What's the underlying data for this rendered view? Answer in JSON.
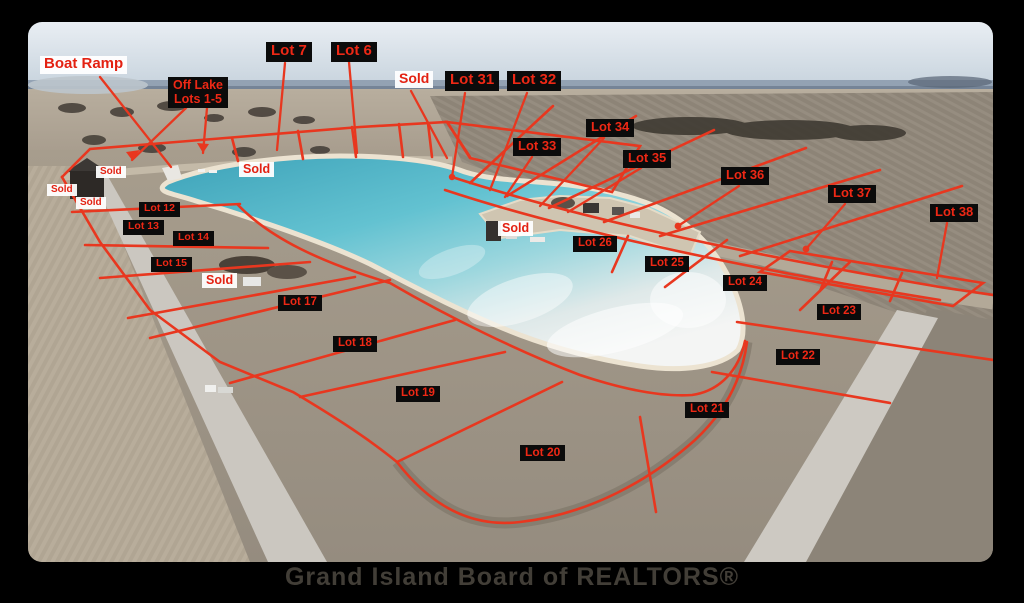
{
  "frame": {
    "watermark": "Grand Island Board of REALTORS®"
  },
  "colors": {
    "line_red": "#e8371f",
    "label_dark_bg": "#0b0b0b",
    "label_red_text": "#ee2815",
    "label_light_bg": "#ffffff",
    "lake_teal": "#54b6c8",
    "lake_glare": "#f3f5f4",
    "field_tan": "#a89d8e",
    "sky": "#dbe5ec"
  },
  "labels": [
    {
      "id": "boat-ramp",
      "text": "Boat Ramp",
      "style": "light",
      "x": 40,
      "y": 56,
      "fs": 15
    },
    {
      "id": "off-lake-lots-1-5",
      "text": "Off Lake\nLots 1-5",
      "style": "dark center",
      "x": 168,
      "y": 77,
      "fs": 12.5
    },
    {
      "id": "lot-7",
      "text": "Lot 7",
      "style": "dark",
      "x": 266,
      "y": 42,
      "fs": 15
    },
    {
      "id": "lot-6",
      "text": "Lot 6",
      "style": "dark",
      "x": 331,
      "y": 42,
      "fs": 15
    },
    {
      "id": "sold-top",
      "text": "Sold",
      "style": "light",
      "x": 395,
      "y": 71,
      "fs": 14
    },
    {
      "id": "lot-31",
      "text": "Lot 31",
      "style": "dark",
      "x": 445,
      "y": 71,
      "fs": 15
    },
    {
      "id": "lot-32",
      "text": "Lot 32",
      "style": "dark",
      "x": 507,
      "y": 71,
      "fs": 15
    },
    {
      "id": "lot-34",
      "text": "Lot 34",
      "style": "dark",
      "x": 586,
      "y": 119,
      "fs": 13
    },
    {
      "id": "lot-33",
      "text": "Lot 33",
      "style": "dark",
      "x": 513,
      "y": 138,
      "fs": 13
    },
    {
      "id": "lot-35",
      "text": "Lot 35",
      "style": "dark",
      "x": 623,
      "y": 150,
      "fs": 13
    },
    {
      "id": "lot-36",
      "text": "Lot 36",
      "style": "dark",
      "x": 721,
      "y": 167,
      "fs": 13
    },
    {
      "id": "lot-37",
      "text": "Lot 37",
      "style": "dark",
      "x": 828,
      "y": 185,
      "fs": 13
    },
    {
      "id": "lot-38",
      "text": "Lot 38",
      "style": "dark",
      "x": 930,
      "y": 204,
      "fs": 13
    },
    {
      "id": "sold-north-shore",
      "text": "Sold",
      "style": "light",
      "x": 239,
      "y": 162,
      "fs": 12.5
    },
    {
      "id": "sold-a",
      "text": "Sold",
      "style": "light",
      "x": 96,
      "y": 166,
      "fs": 10
    },
    {
      "id": "sold-b",
      "text": "Sold",
      "style": "light",
      "x": 47,
      "y": 184,
      "fs": 10
    },
    {
      "id": "sold-c",
      "text": "Sold",
      "style": "light",
      "x": 76,
      "y": 197,
      "fs": 10
    },
    {
      "id": "lot-12",
      "text": "Lot 12",
      "style": "dark",
      "x": 139,
      "y": 202,
      "fs": 10.5
    },
    {
      "id": "lot-13",
      "text": "Lot 13",
      "style": "dark",
      "x": 123,
      "y": 220,
      "fs": 10.5
    },
    {
      "id": "lot-14",
      "text": "Lot 14",
      "style": "dark",
      "x": 173,
      "y": 231,
      "fs": 10.5
    },
    {
      "id": "lot-15",
      "text": "Lot 15",
      "style": "dark",
      "x": 151,
      "y": 257,
      "fs": 10.5
    },
    {
      "id": "sold-16",
      "text": "Sold",
      "style": "light",
      "x": 202,
      "y": 273,
      "fs": 12.5
    },
    {
      "id": "sold-center",
      "text": "Sold",
      "style": "light",
      "x": 498,
      "y": 221,
      "fs": 12.5
    },
    {
      "id": "lot-26",
      "text": "Lot 26",
      "style": "dark",
      "x": 573,
      "y": 236,
      "fs": 11.5
    },
    {
      "id": "lot-25",
      "text": "Lot 25",
      "style": "dark",
      "x": 645,
      "y": 256,
      "fs": 11.5
    },
    {
      "id": "lot-24",
      "text": "Lot 24",
      "style": "dark",
      "x": 723,
      "y": 275,
      "fs": 11.5
    },
    {
      "id": "lot-23",
      "text": "Lot 23",
      "style": "dark",
      "x": 817,
      "y": 304,
      "fs": 11.5
    },
    {
      "id": "lot-17",
      "text": "Lot 17",
      "style": "dark",
      "x": 278,
      "y": 295,
      "fs": 11.5
    },
    {
      "id": "lot-18",
      "text": "Lot 18",
      "style": "dark",
      "x": 333,
      "y": 336,
      "fs": 11.5
    },
    {
      "id": "lot-22",
      "text": "Lot 22",
      "style": "dark",
      "x": 776,
      "y": 349,
      "fs": 11.5
    },
    {
      "id": "lot-19",
      "text": "Lot 19",
      "style": "dark",
      "x": 396,
      "y": 386,
      "fs": 11.5
    },
    {
      "id": "lot-21",
      "text": "Lot 21",
      "style": "dark",
      "x": 685,
      "y": 402,
      "fs": 11.5
    },
    {
      "id": "lot-20",
      "text": "Lot 20",
      "style": "dark",
      "x": 520,
      "y": 445,
      "fs": 12
    }
  ]
}
